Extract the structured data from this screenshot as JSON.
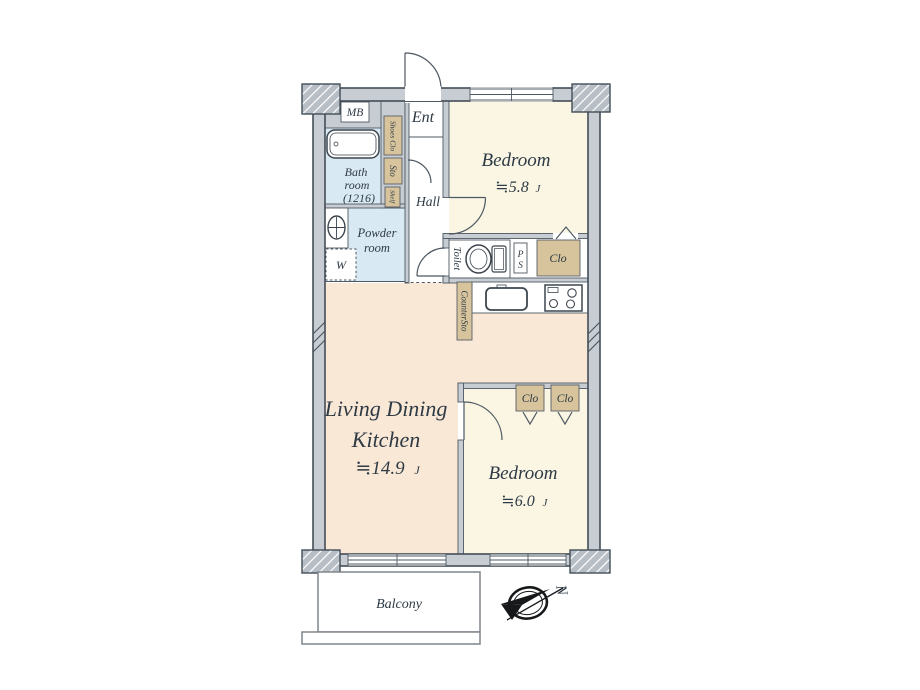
{
  "colors": {
    "wall_fill": "#c7cdd3",
    "wall_outline": "#434d57",
    "pillar_fill": "#b7bec6",
    "bedroom": "#faf6e3",
    "ldk": "#fae8d6",
    "wet_room": "#d9e9f4",
    "closet": "#d7c49c",
    "counter": "#ffffff",
    "text": "#2e3a45"
  },
  "rooms": {
    "bedroom1": {
      "label": "Bedroom",
      "size": "≒5.8",
      "unit": "J"
    },
    "bedroom2": {
      "label": "Bedroom",
      "size": "≒6.0",
      "unit": "J"
    },
    "ldk": {
      "line1": "Living Dining",
      "line2": "Kitchen",
      "size": "≒14.9",
      "unit": "J"
    },
    "bath": {
      "line1": "Bath",
      "line2": "room",
      "line3": "(1216)"
    },
    "powder": {
      "line1": "Powder",
      "line2": "room"
    },
    "toilet": {
      "label": "Toilet"
    },
    "hall": {
      "label": "Hall"
    },
    "ent": {
      "label": "Ent"
    },
    "balcony": {
      "label": "Balcony"
    }
  },
  "storage": {
    "shoes_clo": "Shoes Clo",
    "sto": "Sto",
    "shelf": "Shelf",
    "counter_sto": "CounterSto",
    "clo_hall": "Clo",
    "clo_bedroom2_left": "Clo",
    "clo_bedroom2_right": "Clo"
  },
  "fixtures": {
    "meter_box": "MB",
    "pipe_space_line1": "P",
    "pipe_space_line2": "S",
    "washer": "W"
  },
  "compass": {
    "north": "N"
  }
}
